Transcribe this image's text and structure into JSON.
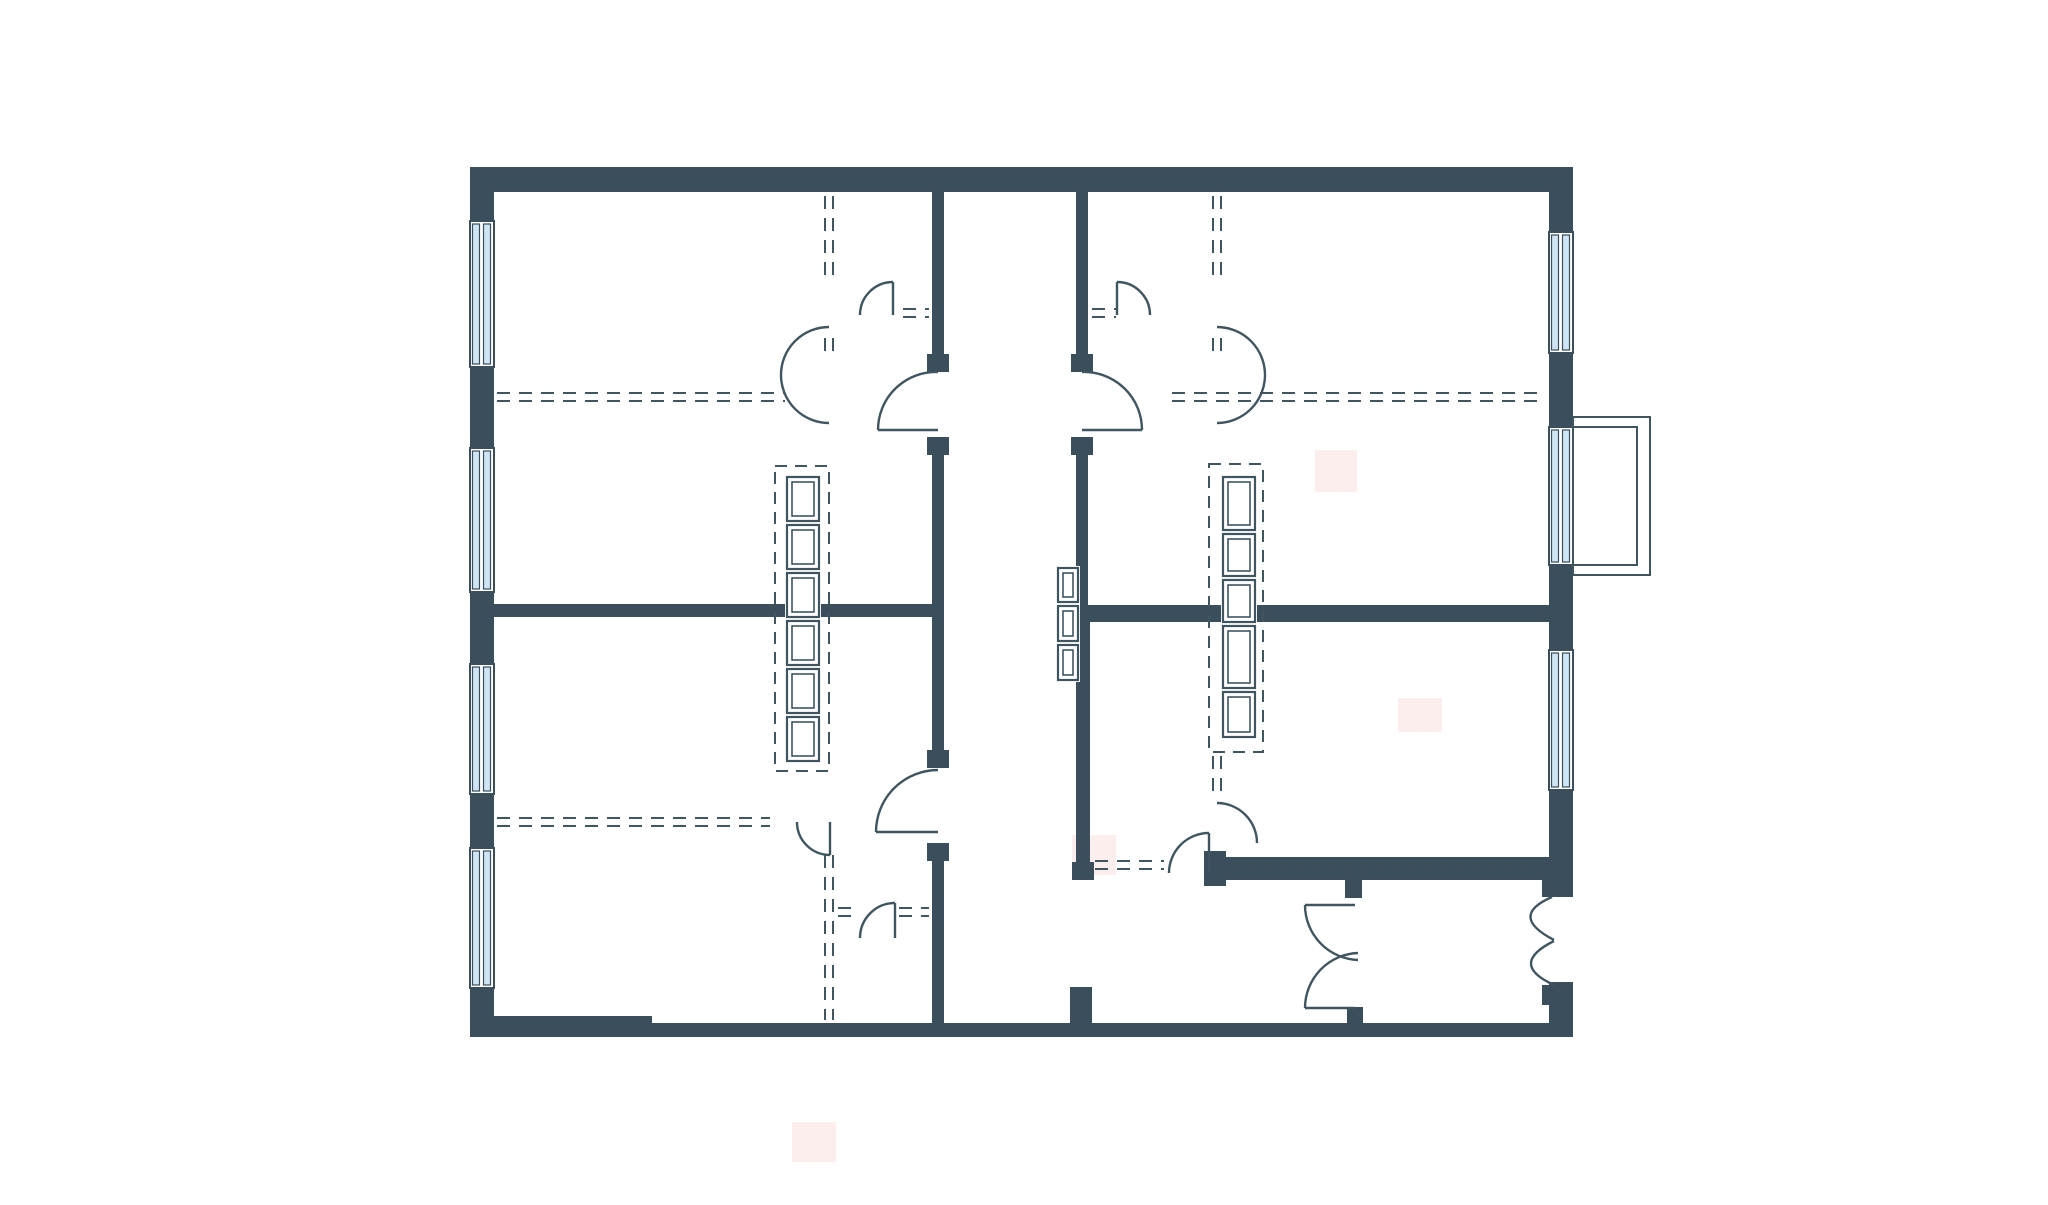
{
  "meta": {
    "title": "apartment-floor-plan",
    "type": "architectural-plan",
    "text_content": ""
  },
  "canvas": {
    "width": 2048,
    "height": 1205,
    "background": "#ffffff"
  },
  "colors": {
    "wall": "#3a4f5b",
    "line": "#3f5560",
    "window_glass": "#cfe4f4",
    "window_frame": "#3a4f5b",
    "watermark": "#fbeeec",
    "paper": "#ffffff"
  },
  "plan": {
    "walls": [
      {
        "name": "wall-top",
        "x": 470,
        "y": 167,
        "w": 1103,
        "h": 25
      },
      {
        "name": "wall-left",
        "x": 470,
        "y": 167,
        "w": 24,
        "h": 870
      },
      {
        "name": "wall-right-upper",
        "x": 1549,
        "y": 167,
        "w": 24,
        "h": 730
      },
      {
        "name": "wall-right-lower",
        "x": 1549,
        "y": 982,
        "w": 24,
        "h": 55
      },
      {
        "name": "wall-bottom",
        "x": 470,
        "y": 1023,
        "w": 1103,
        "h": 14
      },
      {
        "name": "wall-bottom-thick-left",
        "x": 470,
        "y": 1016,
        "w": 182,
        "h": 10
      },
      {
        "name": "corridor-left-wall-upper",
        "x": 932,
        "y": 192,
        "w": 12,
        "h": 180
      },
      {
        "name": "corridor-left-wall-mid",
        "x": 932,
        "y": 437,
        "w": 12,
        "h": 331
      },
      {
        "name": "corridor-left-wall-lower",
        "x": 932,
        "y": 843,
        "w": 12,
        "h": 180
      },
      {
        "name": "corridor-right-wall-upper-a",
        "x": 1076,
        "y": 192,
        "w": 12,
        "h": 180
      },
      {
        "name": "corridor-right-wall-upper-b",
        "x": 1076,
        "y": 437,
        "w": 12,
        "h": 168
      },
      {
        "name": "bathroom-left-wall",
        "x": 1076,
        "y": 605,
        "w": 14,
        "h": 257
      },
      {
        "name": "room-divider-left",
        "x": 494,
        "y": 604,
        "w": 450,
        "h": 13
      },
      {
        "name": "room-divider-right",
        "x": 1090,
        "y": 605,
        "w": 459,
        "h": 17
      },
      {
        "name": "bathroom-bottom-wall",
        "x": 1212,
        "y": 857,
        "w": 361,
        "h": 23
      },
      {
        "name": "cap-bathroom-door-jamb",
        "x": 1204,
        "y": 851,
        "w": 22,
        "h": 35
      },
      {
        "name": "cap-bathroom-left-bottom",
        "x": 1072,
        "y": 862,
        "w": 22,
        "h": 18
      },
      {
        "name": "stub-corridor-bottom",
        "x": 1070,
        "y": 987,
        "w": 22,
        "h": 38
      },
      {
        "name": "post-hall-door-top",
        "x": 1345,
        "y": 880,
        "w": 17,
        "h": 18
      },
      {
        "name": "post-hall-door-bottom",
        "x": 1347,
        "y": 1007,
        "w": 16,
        "h": 16
      },
      {
        "name": "post-entry-door-top",
        "x": 1542,
        "y": 880,
        "w": 20,
        "h": 17
      },
      {
        "name": "post-entry-door-bottom",
        "x": 1542,
        "y": 985,
        "w": 20,
        "h": 20
      },
      {
        "name": "cap-corridor-left-upper-1",
        "x": 927,
        "y": 354,
        "w": 22,
        "h": 18
      },
      {
        "name": "cap-corridor-left-upper-2",
        "x": 927,
        "y": 437,
        "w": 22,
        "h": 18
      },
      {
        "name": "cap-corridor-right-upper-1",
        "x": 1071,
        "y": 354,
        "w": 22,
        "h": 18
      },
      {
        "name": "cap-corridor-right-upper-2",
        "x": 1071,
        "y": 437,
        "w": 22,
        "h": 18
      },
      {
        "name": "cap-corridor-left-lower-1",
        "x": 927,
        "y": 750,
        "w": 22,
        "h": 18
      },
      {
        "name": "cap-corridor-left-lower-2",
        "x": 927,
        "y": 843,
        "w": 22,
        "h": 18
      }
    ],
    "windows": [
      {
        "name": "window-left-1",
        "x": 470,
        "y": 221,
        "w": 24,
        "h": 146
      },
      {
        "name": "window-left-2",
        "x": 470,
        "y": 448,
        "w": 24,
        "h": 144
      },
      {
        "name": "window-left-3",
        "x": 470,
        "y": 664,
        "w": 24,
        "h": 130
      },
      {
        "name": "window-left-4",
        "x": 470,
        "y": 848,
        "w": 24,
        "h": 140
      },
      {
        "name": "window-right-1",
        "x": 1549,
        "y": 232,
        "w": 24,
        "h": 121
      },
      {
        "name": "window-right-2",
        "x": 1549,
        "y": 427,
        "w": 24,
        "h": 138
      },
      {
        "name": "window-right-3",
        "x": 1549,
        "y": 650,
        "w": 24,
        "h": 140
      }
    ],
    "balcony": [
      {
        "name": "balcony-outer",
        "x": 1573,
        "y": 417,
        "w": 77,
        "h": 158
      },
      {
        "name": "balcony-inner",
        "x": 1573,
        "y": 427,
        "w": 64,
        "h": 138
      }
    ],
    "wardrobes": [
      {
        "name": "wardrobe-left-room",
        "x": 787,
        "w": 32,
        "boxes": [
          {
            "y": 477,
            "h": 44
          },
          {
            "y": 525,
            "h": 44
          },
          {
            "y": 573,
            "h": 44
          },
          {
            "y": 621,
            "h": 44
          },
          {
            "y": 669,
            "h": 44
          },
          {
            "y": 717,
            "h": 44
          }
        ]
      },
      {
        "name": "wardrobe-corridor",
        "x": 1058,
        "w": 20,
        "boxes": [
          {
            "y": 568,
            "h": 34
          },
          {
            "y": 606,
            "h": 35
          },
          {
            "y": 645,
            "h": 35
          }
        ]
      },
      {
        "name": "wardrobe-right-room",
        "x": 1223,
        "w": 32,
        "boxes": [
          {
            "y": 477,
            "h": 53
          },
          {
            "y": 534,
            "h": 42
          },
          {
            "y": 580,
            "h": 42
          },
          {
            "y": 626,
            "h": 62
          },
          {
            "y": 692,
            "h": 45
          }
        ]
      }
    ],
    "dashed_rects": [
      {
        "name": "wardrobe-left-dashed-outline",
        "x": 775,
        "y": 466,
        "w": 54,
        "h": 305
      },
      {
        "name": "wardrobe-right-dashed-outline",
        "x": 1209,
        "y": 464,
        "w": 54,
        "h": 288
      }
    ],
    "dashed_lines": [
      {
        "name": "partition-left-horiz-upper-a",
        "x1": 497,
        "y1": 393,
        "x2": 785,
        "y2": 393
      },
      {
        "name": "partition-left-horiz-upper-b",
        "x1": 497,
        "y1": 401,
        "x2": 785,
        "y2": 401
      },
      {
        "name": "partition-left-connector-a",
        "x1": 903,
        "y1": 309,
        "x2": 929,
        "y2": 309
      },
      {
        "name": "partition-left-connector-b",
        "x1": 903,
        "y1": 317,
        "x2": 929,
        "y2": 317
      },
      {
        "name": "partition-left-vert-top-a",
        "x1": 825,
        "y1": 196,
        "x2": 825,
        "y2": 278
      },
      {
        "name": "partition-left-vert-top-b",
        "x1": 833,
        "y1": 196,
        "x2": 833,
        "y2": 278
      },
      {
        "name": "partition-left-vert-mid-a",
        "x1": 825,
        "y1": 338,
        "x2": 825,
        "y2": 360
      },
      {
        "name": "partition-left-vert-mid-b",
        "x1": 833,
        "y1": 338,
        "x2": 833,
        "y2": 360
      },
      {
        "name": "partition-left-horiz-lower-a",
        "x1": 497,
        "y1": 818,
        "x2": 770,
        "y2": 818
      },
      {
        "name": "partition-left-horiz-lower-b",
        "x1": 497,
        "y1": 826,
        "x2": 770,
        "y2": 826
      },
      {
        "name": "partition-left-lower-connector-a",
        "x1": 838,
        "y1": 908,
        "x2": 858,
        "y2": 908
      },
      {
        "name": "partition-left-lower-connector-b",
        "x1": 838,
        "y1": 916,
        "x2": 858,
        "y2": 916
      },
      {
        "name": "partition-left-lower-connector-c",
        "x1": 899,
        "y1": 908,
        "x2": 929,
        "y2": 908
      },
      {
        "name": "partition-left-lower-connector-d",
        "x1": 899,
        "y1": 916,
        "x2": 929,
        "y2": 916
      },
      {
        "name": "partition-left-vert-bottom-a",
        "x1": 825,
        "y1": 855,
        "x2": 825,
        "y2": 1020
      },
      {
        "name": "partition-left-vert-bottom-b",
        "x1": 833,
        "y1": 855,
        "x2": 833,
        "y2": 1020
      },
      {
        "name": "partition-right-horiz-a",
        "x1": 1172,
        "y1": 393,
        "x2": 1546,
        "y2": 393
      },
      {
        "name": "partition-right-horiz-b",
        "x1": 1172,
        "y1": 401,
        "x2": 1546,
        "y2": 401
      },
      {
        "name": "partition-right-connector-a",
        "x1": 1092,
        "y1": 309,
        "x2": 1116,
        "y2": 309
      },
      {
        "name": "partition-right-connector-b",
        "x1": 1092,
        "y1": 317,
        "x2": 1116,
        "y2": 317
      },
      {
        "name": "partition-right-vert-top-a",
        "x1": 1213,
        "y1": 196,
        "x2": 1213,
        "y2": 278
      },
      {
        "name": "partition-right-vert-top-b",
        "x1": 1221,
        "y1": 196,
        "x2": 1221,
        "y2": 278
      },
      {
        "name": "partition-right-vert-mid-a",
        "x1": 1213,
        "y1": 338,
        "x2": 1213,
        "y2": 360
      },
      {
        "name": "partition-right-vert-mid-b",
        "x1": 1221,
        "y1": 338,
        "x2": 1221,
        "y2": 360
      },
      {
        "name": "partition-right-vert-bottom-a",
        "x1": 1213,
        "y1": 756,
        "x2": 1213,
        "y2": 800
      },
      {
        "name": "partition-right-vert-bottom-b",
        "x1": 1221,
        "y1": 756,
        "x2": 1221,
        "y2": 800
      },
      {
        "name": "bathroom-door-connector-a",
        "x1": 1095,
        "y1": 861,
        "x2": 1164,
        "y2": 861
      },
      {
        "name": "bathroom-door-connector-b",
        "x1": 1095,
        "y1": 869,
        "x2": 1164,
        "y2": 869
      }
    ],
    "doors": [
      {
        "name": "door-left-room-corridor",
        "arc": "M 878,430 A 58,58 0 0 1 938,372",
        "leaf": [
          938,
          430,
          878,
          430
        ]
      },
      {
        "name": "door-bottomleft-room-corridor",
        "arc": "M 876,832 A 62,62 0 0 1 938,770",
        "leaf": [
          938,
          832,
          876,
          832
        ]
      },
      {
        "name": "door-right-room-corridor",
        "arc": "M 1142,430 A 58,58 0 0 0 1082,372",
        "leaf": [
          1082,
          430,
          1142,
          430
        ]
      },
      {
        "name": "door-left-partition-small",
        "arc": "M 860,315 A 33,33 0 0 1 893,282",
        "leaf": [
          893,
          282,
          893,
          315
        ]
      },
      {
        "name": "door-right-partition-small",
        "arc": "M 1150,315 A 33,33 0 0 0 1117,282",
        "leaf": [
          1117,
          282,
          1117,
          315
        ]
      },
      {
        "name": "door-left-partition-double-a",
        "arc": "M 829,327 A 48,48 0 0 0 781,375",
        "leaf": null
      },
      {
        "name": "door-left-partition-double-b",
        "arc": "M 781,375 A 48,48 0 0 0 829,423",
        "leaf": null
      },
      {
        "name": "door-right-partition-double-a",
        "arc": "M 1217,327 A 48,48 0 0 1 1265,375",
        "leaf": null
      },
      {
        "name": "door-right-partition-double-b",
        "arc": "M 1265,375 A 48,48 0 0 1 1217,423",
        "leaf": null
      },
      {
        "name": "door-left-lower-partition",
        "arc": "M 797,822 A 33,33 0 0 0 830,855",
        "leaf": [
          830,
          822,
          830,
          855
        ]
      },
      {
        "name": "door-bottomleft-partition",
        "arc": "M 895,903 A 35,35 0 0 0 860,938",
        "leaf": [
          895,
          903,
          895,
          938
        ]
      },
      {
        "name": "door-right-vert-partition-end",
        "arc": "M 1217,803 A 40,40 0 0 1 1257,843",
        "leaf": null
      },
      {
        "name": "door-bathroom",
        "arc": "M 1209,833 A 40,40 0 0 0 1169,873",
        "leaf": [
          1209,
          873,
          1209,
          833
        ]
      },
      {
        "name": "door-hall-double-top",
        "arc": "M 1305,905 A 55,55 0 0 0 1358,960",
        "leaf": [
          1355,
          905,
          1305,
          905
        ]
      },
      {
        "name": "door-hall-double-bottom",
        "arc": "M 1305,1008 A 55,55 0 0 1 1358,953",
        "leaf": [
          1355,
          1008,
          1305,
          1008
        ]
      },
      {
        "name": "door-entry-double-top",
        "arc": "M 1552,897 Q 1508,916 1554,940",
        "leaf": null
      },
      {
        "name": "door-entry-double-bottom",
        "arc": "M 1554,985 Q 1508,964 1554,941",
        "leaf": null
      }
    ],
    "watermarks": [
      {
        "name": "watermark-blob-1",
        "x": 1315,
        "y": 450,
        "w": 42,
        "h": 42
      },
      {
        "name": "watermark-blob-2",
        "x": 1398,
        "y": 698,
        "w": 44,
        "h": 34
      },
      {
        "name": "watermark-blob-3",
        "x": 1072,
        "y": 835,
        "w": 44,
        "h": 40
      },
      {
        "name": "watermark-blob-4",
        "x": 792,
        "y": 1122,
        "w": 44,
        "h": 40
      }
    ]
  }
}
